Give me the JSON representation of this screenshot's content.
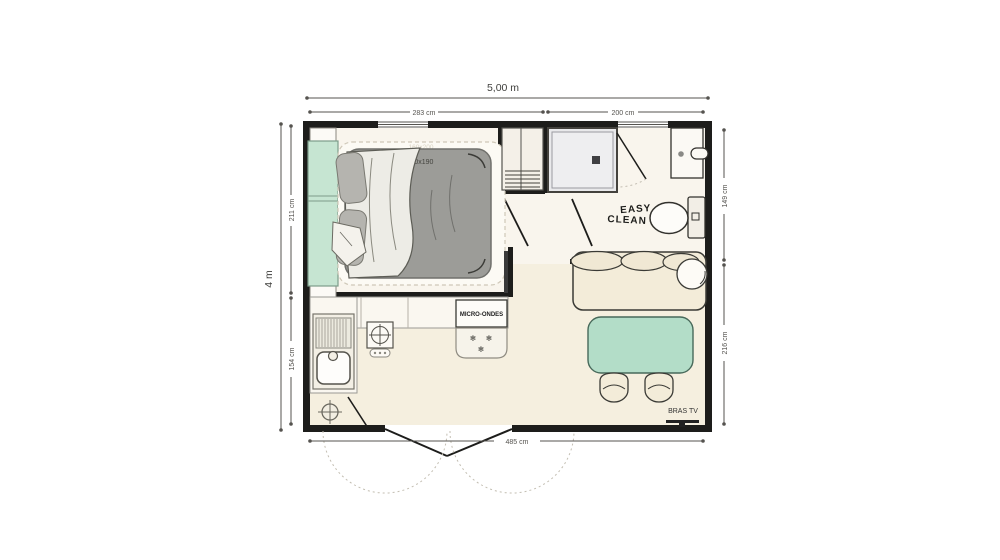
{
  "dimensions": {
    "overall_width": "5,00 m",
    "overall_height": "4 m",
    "top_section_left": "283 cm",
    "top_section_right": "200 cm",
    "left_section_top": "211 cm",
    "left_section_bottom": "154 cm",
    "right_section_top": "149 cm",
    "right_section_bottom": "216 cm",
    "bottom_section": "485 cm"
  },
  "labels": {
    "bed_size": "140x190",
    "bed_topper_size": "160x200",
    "microwave": "MICRO-ONDES",
    "brand_line1": "EASY",
    "brand_line2": "CLEAN",
    "tv_bracket": "BRAS TV",
    "snowflake": "❄"
  },
  "colors": {
    "wall": "#1d1d1b",
    "floor_warm": "#f5efdf",
    "floor_light": "#f9f5ed",
    "furniture_green": "#c6e5d2",
    "table_green": "#b3ddc8",
    "upholstery_cream": "#f3ecd9",
    "mattress_gray": "#9c9c98",
    "dimension": "#55534f"
  }
}
